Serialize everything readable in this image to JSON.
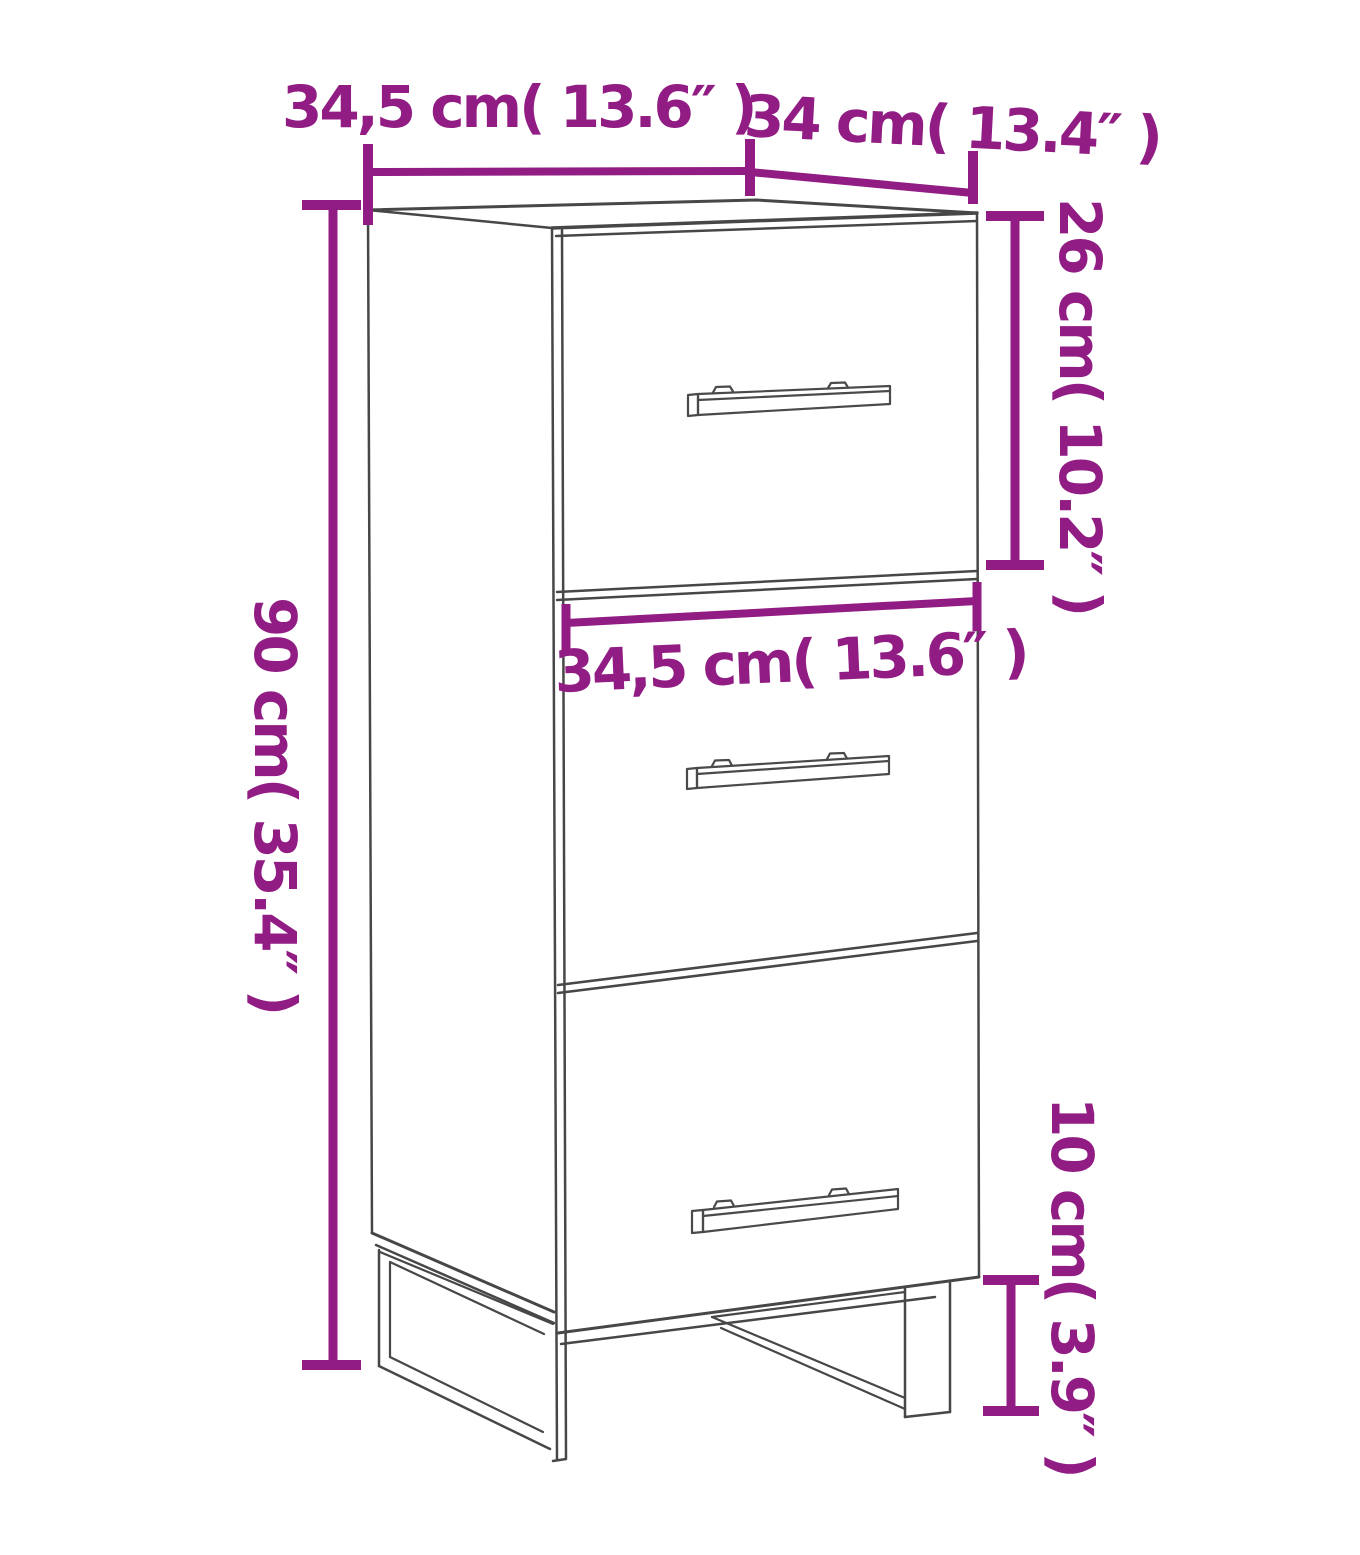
{
  "diagram": {
    "type": "furniture-dimension-diagram",
    "subject": "three-drawer cabinet with metal U-shaped legs",
    "background_color": "#ffffff",
    "line_color": "#474747",
    "accent_color": "#911c84",
    "labels": {
      "top_width": "34,5 cm( 13.6″ )",
      "top_depth": "34 cm( 13.4″ )",
      "top_drawer_height": "26 cm( 10.2″ )",
      "overall_height": "90 cm( 35.4″ )",
      "middle_drawer_width": "34,5 cm( 13.6″ )",
      "leg_height": "10 cm( 3.9″ )"
    }
  }
}
